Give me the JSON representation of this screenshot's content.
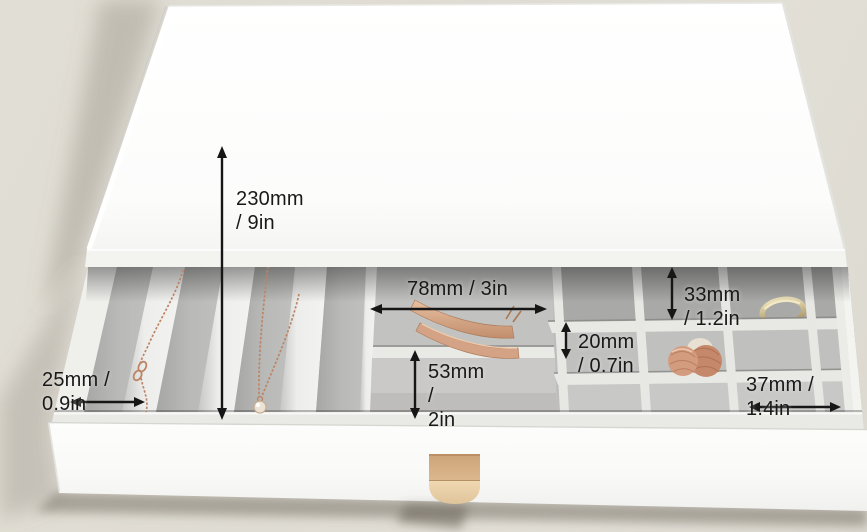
{
  "scene": {
    "title": "White jewellery box with open drawer and measurement annotations",
    "background_color": "#dfdcd3",
    "box_color": "#fdfdfd",
    "velvet_color": "#c6c6c4",
    "handle_color": "#d5ad80",
    "rose_gold_color": "#c48a6b",
    "gold_color": "#bfae7e",
    "annotation_color": "#191919"
  },
  "dimensions": {
    "box_height": "230mm / 9in",
    "clip_compartment_width": "78mm / 3in",
    "small_compartment_height": "33mm / 1.2in",
    "mini_compartment_height": "20mm / 0.7in",
    "necklace_channel_width": "25mm / 0.9in",
    "front_section_depth": "53mm /\n2in",
    "bottom_compartment_width": "37mm / 1.4in"
  }
}
